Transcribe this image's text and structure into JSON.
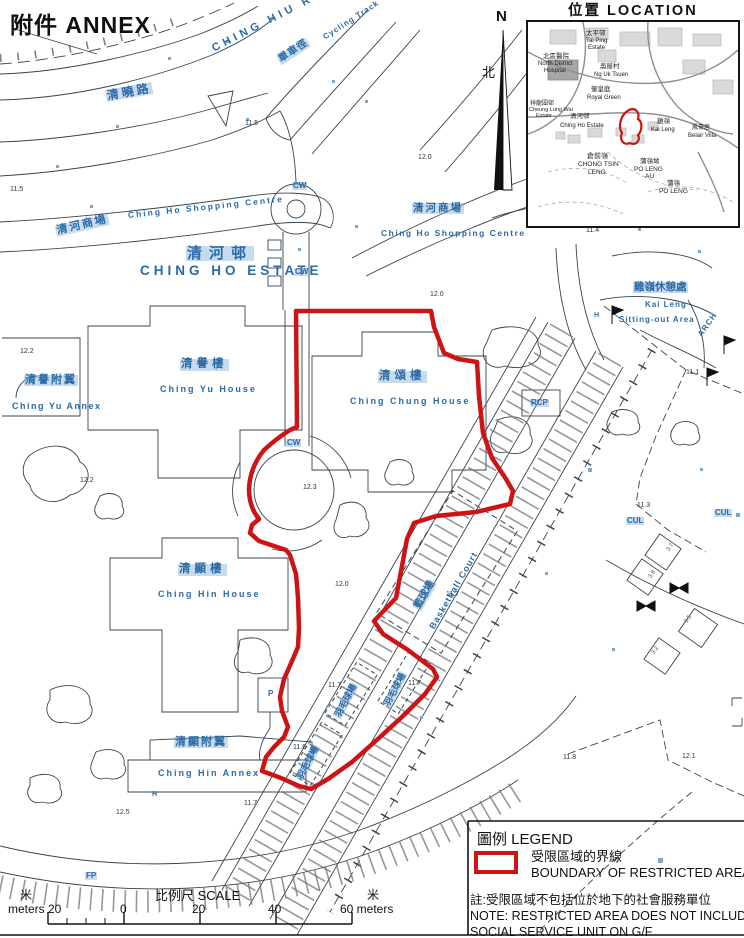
{
  "page": {
    "annex_title": "附件  ANNEX"
  },
  "north": {
    "n": "N",
    "zh": "北"
  },
  "colors": {
    "boundary_red": "#cc1414",
    "label_blue": "#2a6aa6",
    "line_dark": "#36454f"
  },
  "inset": {
    "title": "位置  LOCATION",
    "labels": [
      {
        "t": "太平邨",
        "x": 58,
        "y": 9,
        "fs": 6.5,
        "n": "inset-tai-ping-estate-zh"
      },
      {
        "t": "Tai Ping",
        "x": 58,
        "y": 16,
        "n": "inset-tai-ping-estate-en"
      },
      {
        "t": "Estate",
        "x": 60,
        "y": 23,
        "n": "inset-tai-ping-estate-en2"
      },
      {
        "t": "北區醫院",
        "x": 15,
        "y": 32,
        "fs": 6.5,
        "n": "inset-north-district-hospital-zh"
      },
      {
        "t": "North District",
        "x": 10,
        "y": 39,
        "n": "inset-north-district-hospital-en"
      },
      {
        "t": "Hospital",
        "x": 16,
        "y": 46,
        "n": "inset-north-district-hospital-en2"
      },
      {
        "t": "吳屋村",
        "x": 72,
        "y": 42,
        "fs": 6.5,
        "n": "inset-ng-uk-tsuen-zh"
      },
      {
        "t": "Ng Uk Tsuen",
        "x": 66,
        "y": 50,
        "n": "inset-ng-uk-tsuen-en"
      },
      {
        "t": "御皇庭",
        "x": 63,
        "y": 65,
        "fs": 6.5,
        "n": "inset-royal-green-zh"
      },
      {
        "t": "Royal Green",
        "x": 59,
        "y": 73,
        "n": "inset-royal-green-en"
      },
      {
        "t": "祥龍圍邨",
        "x": 2,
        "y": 79,
        "fs": 6,
        "n": "inset-cheung-lung-wai-zh"
      },
      {
        "t": "Cheung Lung Wai",
        "x": 1,
        "y": 86,
        "fs": 5.5,
        "n": "inset-cheung-lung-wai-en"
      },
      {
        "t": "Estate",
        "x": 8,
        "y": 92,
        "fs": 5.5,
        "n": "inset-cheung-lung-wai-en2"
      },
      {
        "t": "清河邨",
        "x": 42,
        "y": 92,
        "fs": 6.5,
        "n": "inset-ching-ho-estate-zh"
      },
      {
        "t": "Ching Ho Estate",
        "x": 32,
        "y": 101,
        "n": "inset-ching-ho-estate-en"
      },
      {
        "t": "雞嶺",
        "x": 129,
        "y": 97,
        "fs": 6.5,
        "n": "inset-kai-leng-zh"
      },
      {
        "t": "Kai Leng",
        "x": 123,
        "y": 105,
        "n": "inset-kai-leng-en"
      },
      {
        "t": "鳳豪居",
        "x": 164,
        "y": 103,
        "fs": 6,
        "n": "inset-belair-villa-zh"
      },
      {
        "t": "Belair Villa",
        "x": 160,
        "y": 111,
        "n": "inset-belair-villa-en"
      },
      {
        "t": "倉前嶺",
        "x": 59,
        "y": 131,
        "fs": 7,
        "n": "inset-chong-tsin-leng-zh"
      },
      {
        "t": "CHONG TSIN",
        "x": 50,
        "y": 140,
        "fs": 6.5,
        "n": "inset-chong-tsin-leng-en"
      },
      {
        "t": "LENG",
        "x": 60,
        "y": 148,
        "fs": 6.5,
        "n": "inset-chong-tsin-leng-en2"
      },
      {
        "t": "蒲嶺坳",
        "x": 112,
        "y": 137,
        "fs": 6.5,
        "n": "inset-po-leng-au-zh"
      },
      {
        "t": "PO LENG",
        "x": 106,
        "y": 145,
        "fs": 6.5,
        "n": "inset-po-leng-au-en"
      },
      {
        "t": "AU",
        "x": 117,
        "y": 152,
        "fs": 6.5,
        "n": "inset-po-leng-au-en2"
      },
      {
        "t": "蒲嶺",
        "x": 139,
        "y": 159,
        "fs": 6.5,
        "n": "inset-po-leng-zh"
      },
      {
        "t": "PO LENG",
        "x": 131,
        "y": 167,
        "fs": 6.5,
        "n": "inset-po-leng-en"
      }
    ]
  },
  "map_labels": [
    {
      "t": "CHING HIU ROAD",
      "x": 213,
      "y": 44,
      "fs": 11,
      "rot": -27,
      "ls": 4,
      "n": "label-ching-hiu-road"
    },
    {
      "t": "清曉路",
      "x": 106,
      "y": 90,
      "fs": 12,
      "rot": -10,
      "ls": 3,
      "hl": 1,
      "n": "label-ching-hiu-road-zh"
    },
    {
      "t": "單車徑",
      "x": 279,
      "y": 56,
      "fs": 10,
      "rot": -33,
      "ls": 1,
      "hl": 1,
      "n": "label-cycle-track-zh"
    },
    {
      "t": "Cycling Track",
      "x": 324,
      "y": 34,
      "fs": 8,
      "rot": -33,
      "ls": 1,
      "n": "label-cycling-track"
    },
    {
      "t": "清河商場",
      "x": 56,
      "y": 226,
      "fs": 11,
      "rot": -13,
      "ls": 2,
      "hl": 1,
      "n": "label-shopping-centre-west-zh"
    },
    {
      "t": "Ching Ho Shopping Centre",
      "x": 128,
      "y": 211,
      "fs": 8.5,
      "rot": -6,
      "ls": 2,
      "n": "label-shopping-centre-west-en"
    },
    {
      "t": "清河邨",
      "x": 186,
      "y": 246,
      "fs": 15,
      "ls": 7,
      "hl": 1,
      "n": "label-ching-ho-estate-zh"
    },
    {
      "t": "CHING HO ESTATE",
      "x": 140,
      "y": 264,
      "fs": 13.5,
      "ls": 4,
      "n": "label-ching-ho-estate-en"
    },
    {
      "t": "清河商場",
      "x": 412,
      "y": 203,
      "fs": 10.5,
      "ls": 2,
      "hl": 1,
      "n": "label-shopping-centre-east-zh"
    },
    {
      "t": "Ching Ho Shopping Centre",
      "x": 381,
      "y": 229,
      "fs": 8.5,
      "ls": 1.5,
      "n": "label-shopping-centre-east-en"
    },
    {
      "t": "CW",
      "x": 292,
      "y": 182,
      "fs": 8,
      "hl": 1,
      "n": "label-cw-1"
    },
    {
      "t": "CW",
      "x": 294,
      "y": 268,
      "fs": 8,
      "hl": 1,
      "n": "label-cw-2"
    },
    {
      "t": "CW",
      "x": 286,
      "y": 439,
      "fs": 8,
      "hl": 1,
      "n": "label-cw-3"
    },
    {
      "t": "雞嶺休憩處",
      "x": 633,
      "y": 282,
      "fs": 10.5,
      "hl": 1,
      "n": "label-kai-leng-sitting-out-zh"
    },
    {
      "t": "Kai Leng",
      "x": 645,
      "y": 301,
      "fs": 8,
      "ls": 1,
      "n": "label-kai-leng-sitting-out-en1"
    },
    {
      "t": "Sitting-out Area",
      "x": 619,
      "y": 316,
      "fs": 8,
      "ls": 1,
      "n": "label-kai-leng-sitting-out-en2"
    },
    {
      "t": "ARCH",
      "x": 700,
      "y": 332,
      "fs": 8,
      "rot": -55,
      "ls": 1,
      "n": "label-arch"
    },
    {
      "t": "清譽樓",
      "x": 180,
      "y": 359,
      "fs": 11.5,
      "ls": 4,
      "hl": 1,
      "n": "label-ching-yu-house-zh"
    },
    {
      "t": "Ching Yu House",
      "x": 160,
      "y": 385,
      "fs": 9,
      "ls": 2,
      "n": "label-ching-yu-house-en"
    },
    {
      "t": "清譽附翼",
      "x": 24,
      "y": 375,
      "fs": 11,
      "ls": 2,
      "hl": 1,
      "n": "label-ching-yu-annex-zh"
    },
    {
      "t": "Ching Yu Annex",
      "x": 12,
      "y": 402,
      "fs": 9,
      "ls": 1.5,
      "n": "label-ching-yu-annex-en"
    },
    {
      "t": "清頌樓",
      "x": 378,
      "y": 371,
      "fs": 11.5,
      "ls": 4,
      "hl": 1,
      "n": "label-ching-chung-house-zh"
    },
    {
      "t": "Ching Chung House",
      "x": 350,
      "y": 397,
      "fs": 9,
      "ls": 2,
      "n": "label-ching-chung-house-en"
    },
    {
      "t": "RCP",
      "x": 530,
      "y": 399,
      "fs": 8,
      "hl": 1,
      "n": "label-rcp"
    },
    {
      "t": "清顯樓",
      "x": 178,
      "y": 564,
      "fs": 11.5,
      "ls": 4,
      "hl": 1,
      "n": "label-ching-hin-house-zh"
    },
    {
      "t": "Ching Hin House",
      "x": 158,
      "y": 590,
      "fs": 9,
      "ls": 2,
      "n": "label-ching-hin-house-en"
    },
    {
      "t": "清顯附翼",
      "x": 174,
      "y": 737,
      "fs": 11,
      "ls": 2,
      "hl": 1,
      "n": "label-ching-hin-annex-zh"
    },
    {
      "t": "Ching Hin Annex",
      "x": 158,
      "y": 769,
      "fs": 9,
      "ls": 2,
      "n": "label-ching-hin-annex-en"
    },
    {
      "t": "P",
      "x": 268,
      "y": 690,
      "fs": 8,
      "n": "label-p"
    },
    {
      "t": "H",
      "x": 594,
      "y": 312,
      "fs": 7,
      "n": "label-h-1"
    },
    {
      "t": "H",
      "x": 152,
      "y": 791,
      "fs": 7,
      "n": "label-h-2"
    },
    {
      "t": "CUL",
      "x": 626,
      "y": 517,
      "fs": 8,
      "hl": 1,
      "n": "label-cul-1"
    },
    {
      "t": "CUL",
      "x": 714,
      "y": 509,
      "fs": 8,
      "hl": 1,
      "n": "label-cul-2"
    },
    {
      "t": "籃球場",
      "x": 417,
      "y": 604,
      "fs": 10,
      "rot": -60,
      "hl": 1,
      "n": "label-basketball-court-zh"
    },
    {
      "t": "Basketball Court",
      "x": 432,
      "y": 624,
      "fs": 9,
      "rot": -60,
      "ls": 1,
      "n": "label-basketball-court-en"
    },
    {
      "t": "羽毛球場",
      "x": 337,
      "y": 713,
      "fs": 9,
      "rot": -62,
      "hl": 1,
      "n": "label-badminton-court-1"
    },
    {
      "t": "羽毛球場",
      "x": 386,
      "y": 702,
      "fs": 9,
      "rot": -62,
      "hl": 1,
      "n": "label-badminton-court-2"
    },
    {
      "t": "羽毛球場",
      "x": 299,
      "y": 775,
      "fs": 9,
      "rot": -62,
      "hl": 1,
      "n": "label-badminton-court-3"
    },
    {
      "t": "FP",
      "x": 85,
      "y": 872,
      "fs": 8,
      "hl": 1,
      "n": "label-fp"
    }
  ],
  "spot_heights": [
    {
      "t": "11.5",
      "x": 245,
      "y": 120
    },
    {
      "t": "11.5",
      "x": 10,
      "y": 186
    },
    {
      "t": "12.0",
      "x": 418,
      "y": 154
    },
    {
      "t": "11.4",
      "x": 586,
      "y": 227
    },
    {
      "t": "12.0",
      "x": 430,
      "y": 291
    },
    {
      "t": "12.2",
      "x": 20,
      "y": 348
    },
    {
      "t": "12.2",
      "x": 80,
      "y": 477
    },
    {
      "t": "12.3",
      "x": 303,
      "y": 484
    },
    {
      "t": "12.0",
      "x": 335,
      "y": 581
    },
    {
      "t": "11.7",
      "x": 446,
      "y": 591
    },
    {
      "t": "11.7",
      "x": 328,
      "y": 682
    },
    {
      "t": "11.7",
      "x": 408,
      "y": 680
    },
    {
      "t": "11.6",
      "x": 293,
      "y": 744
    },
    {
      "t": "11.7",
      "x": 244,
      "y": 800
    },
    {
      "t": "12.5",
      "x": 116,
      "y": 809
    },
    {
      "t": "11.1",
      "x": 686,
      "y": 369
    },
    {
      "t": "11.3",
      "x": 637,
      "y": 502
    },
    {
      "t": "11.8",
      "x": 563,
      "y": 754
    },
    {
      "t": "12.1",
      "x": 682,
      "y": 753
    },
    {
      "t": "3.7",
      "x": 668,
      "y": 548,
      "rot": -55,
      "cls": "tiny"
    },
    {
      "t": "3.8",
      "x": 650,
      "y": 575,
      "rot": -55,
      "cls": "tiny"
    },
    {
      "t": "3.5",
      "x": 686,
      "y": 620,
      "rot": -55,
      "cls": "tiny"
    },
    {
      "t": "3.2",
      "x": 653,
      "y": 651,
      "rot": -55,
      "cls": "tiny"
    }
  ],
  "legend": {
    "title": "圖例 LEGEND",
    "boundary_zh": "受限區域的界線",
    "boundary_en": "BOUNDARY OF RESTRICTED AREA",
    "note_zh": "註:受限區域不包括位於地下的社會服務單位",
    "note_en1": "NOTE: RESTRICTED AREA DOES NOT INCLUDE",
    "note_en2": "SOCIAL SERVICE UNIT ON G/F"
  },
  "scale": {
    "left_unit": "米",
    "left_label": "meters 20",
    "zero": "0",
    "title": "比例尺  SCALE",
    "t20": "20",
    "t40": "40",
    "right_label": "60 meters",
    "right_unit": "米"
  }
}
